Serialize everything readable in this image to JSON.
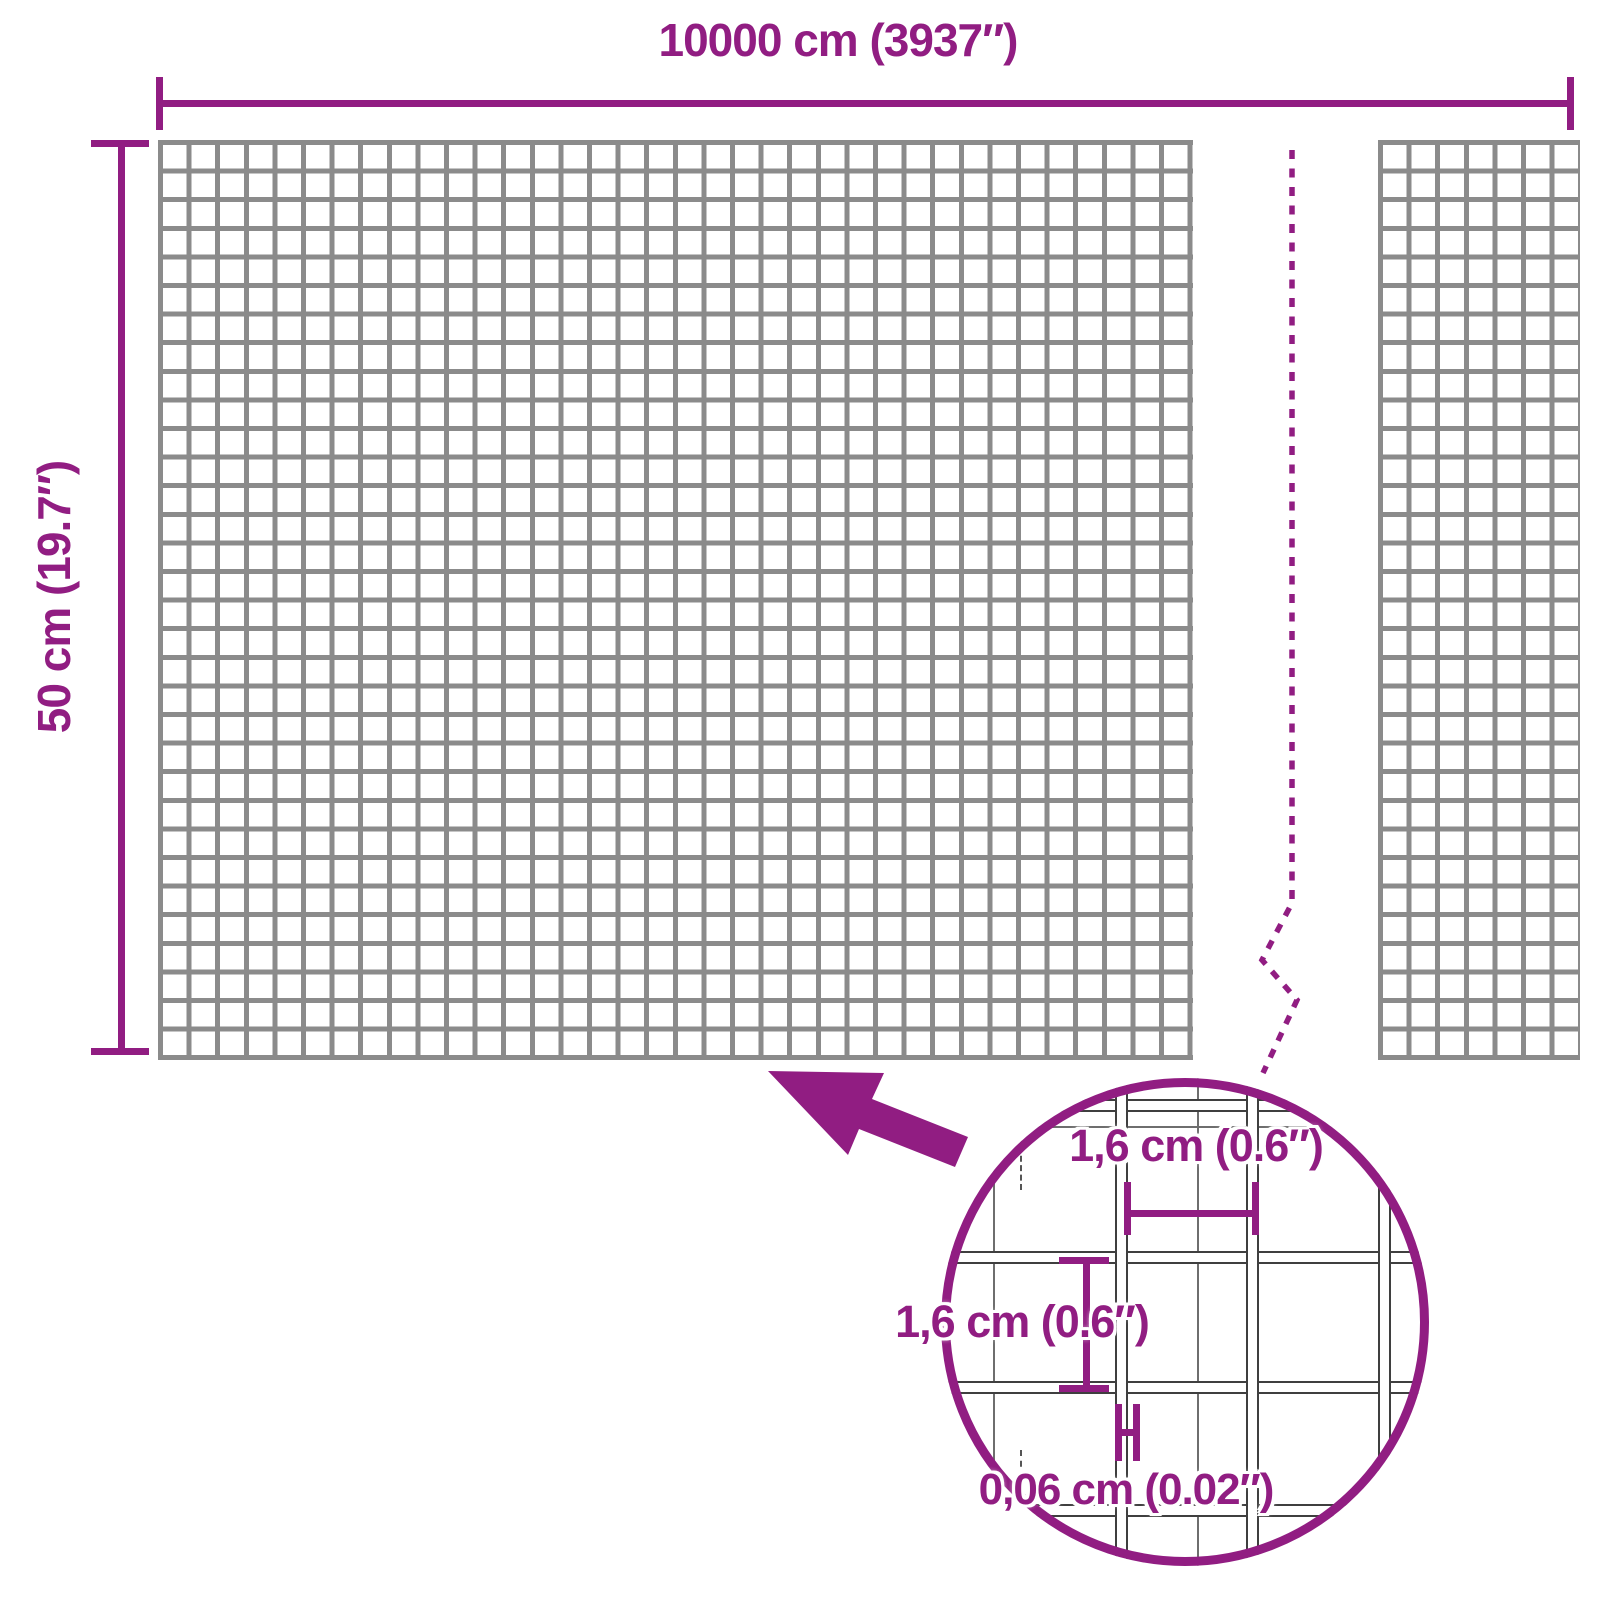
{
  "colors": {
    "accent": "#911d82",
    "mesh_line": "#8b8b8b",
    "wire_outline": "#3f3f3f",
    "extension_line": "#555555",
    "background": "#ffffff"
  },
  "roll": {
    "width_label": "10000 cm (3937″)",
    "height_label": "50 cm (19.7″)"
  },
  "magnifier": {
    "cell_width_label": "1,6 cm (0.6″)",
    "cell_height_label": "1,6 cm (0.6″)",
    "wire_thickness_label": "0,06 cm (0.02″)"
  },
  "icons": {
    "zoom_arrow": "zoom-arrow-icon",
    "break_line": "break-line-icon"
  }
}
